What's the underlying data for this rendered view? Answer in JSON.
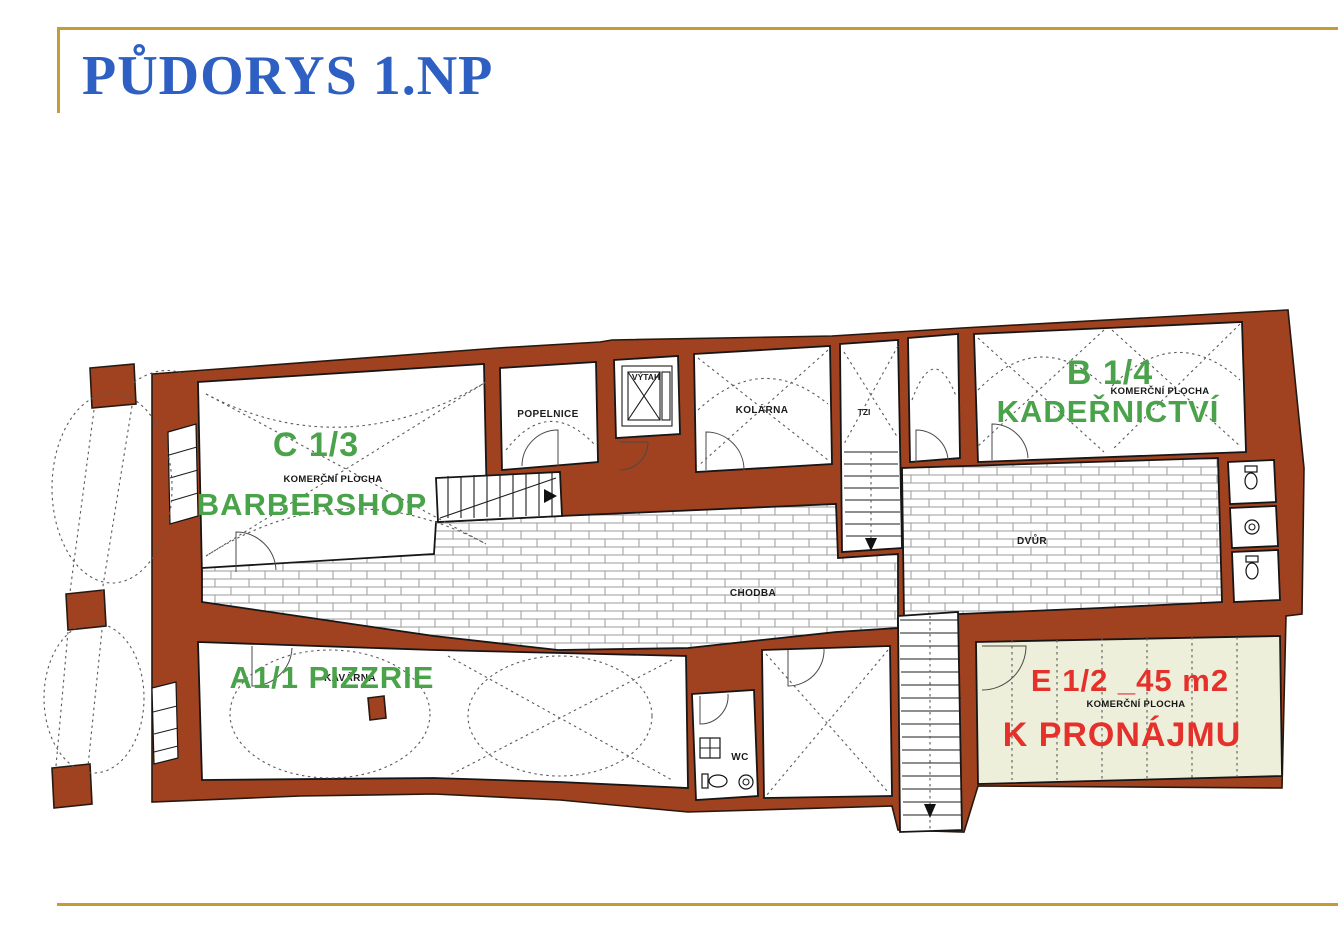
{
  "page": {
    "title": "PŮDORYS 1.NP"
  },
  "colors": {
    "accent_gold": "#C49B35",
    "title_blue": "#2E5FC3",
    "wall_red": "#A0421F",
    "unit_green": "#4AA34A",
    "alert_red": "#E5312B",
    "lease_bg": "#EDEFDA"
  },
  "units": {
    "c": {
      "code": "C 1/3",
      "type": "KOMERČNÍ PLOCHA",
      "name": "BARBERSHOP"
    },
    "b": {
      "code": "B 1/4",
      "type": "KOMERČNÍ PLOCHA",
      "name": "KADEŘNICTVÍ"
    },
    "a": {
      "code": "A1/1 PIZZRIE",
      "sub": "KAVÁRNA"
    },
    "e": {
      "code": "E 1/2 _45 m2",
      "type": "KOMERČNÍ PLOCHA",
      "name": "K PRONÁJMU"
    }
  },
  "rooms": {
    "popelnice": "POPELNICE",
    "vytah": "VÝTAH",
    "kolarna": "KOLÁRNA",
    "tzi": "TZI",
    "dvur": "DVŮR",
    "chodba": "CHODBA",
    "wc": "WC"
  }
}
